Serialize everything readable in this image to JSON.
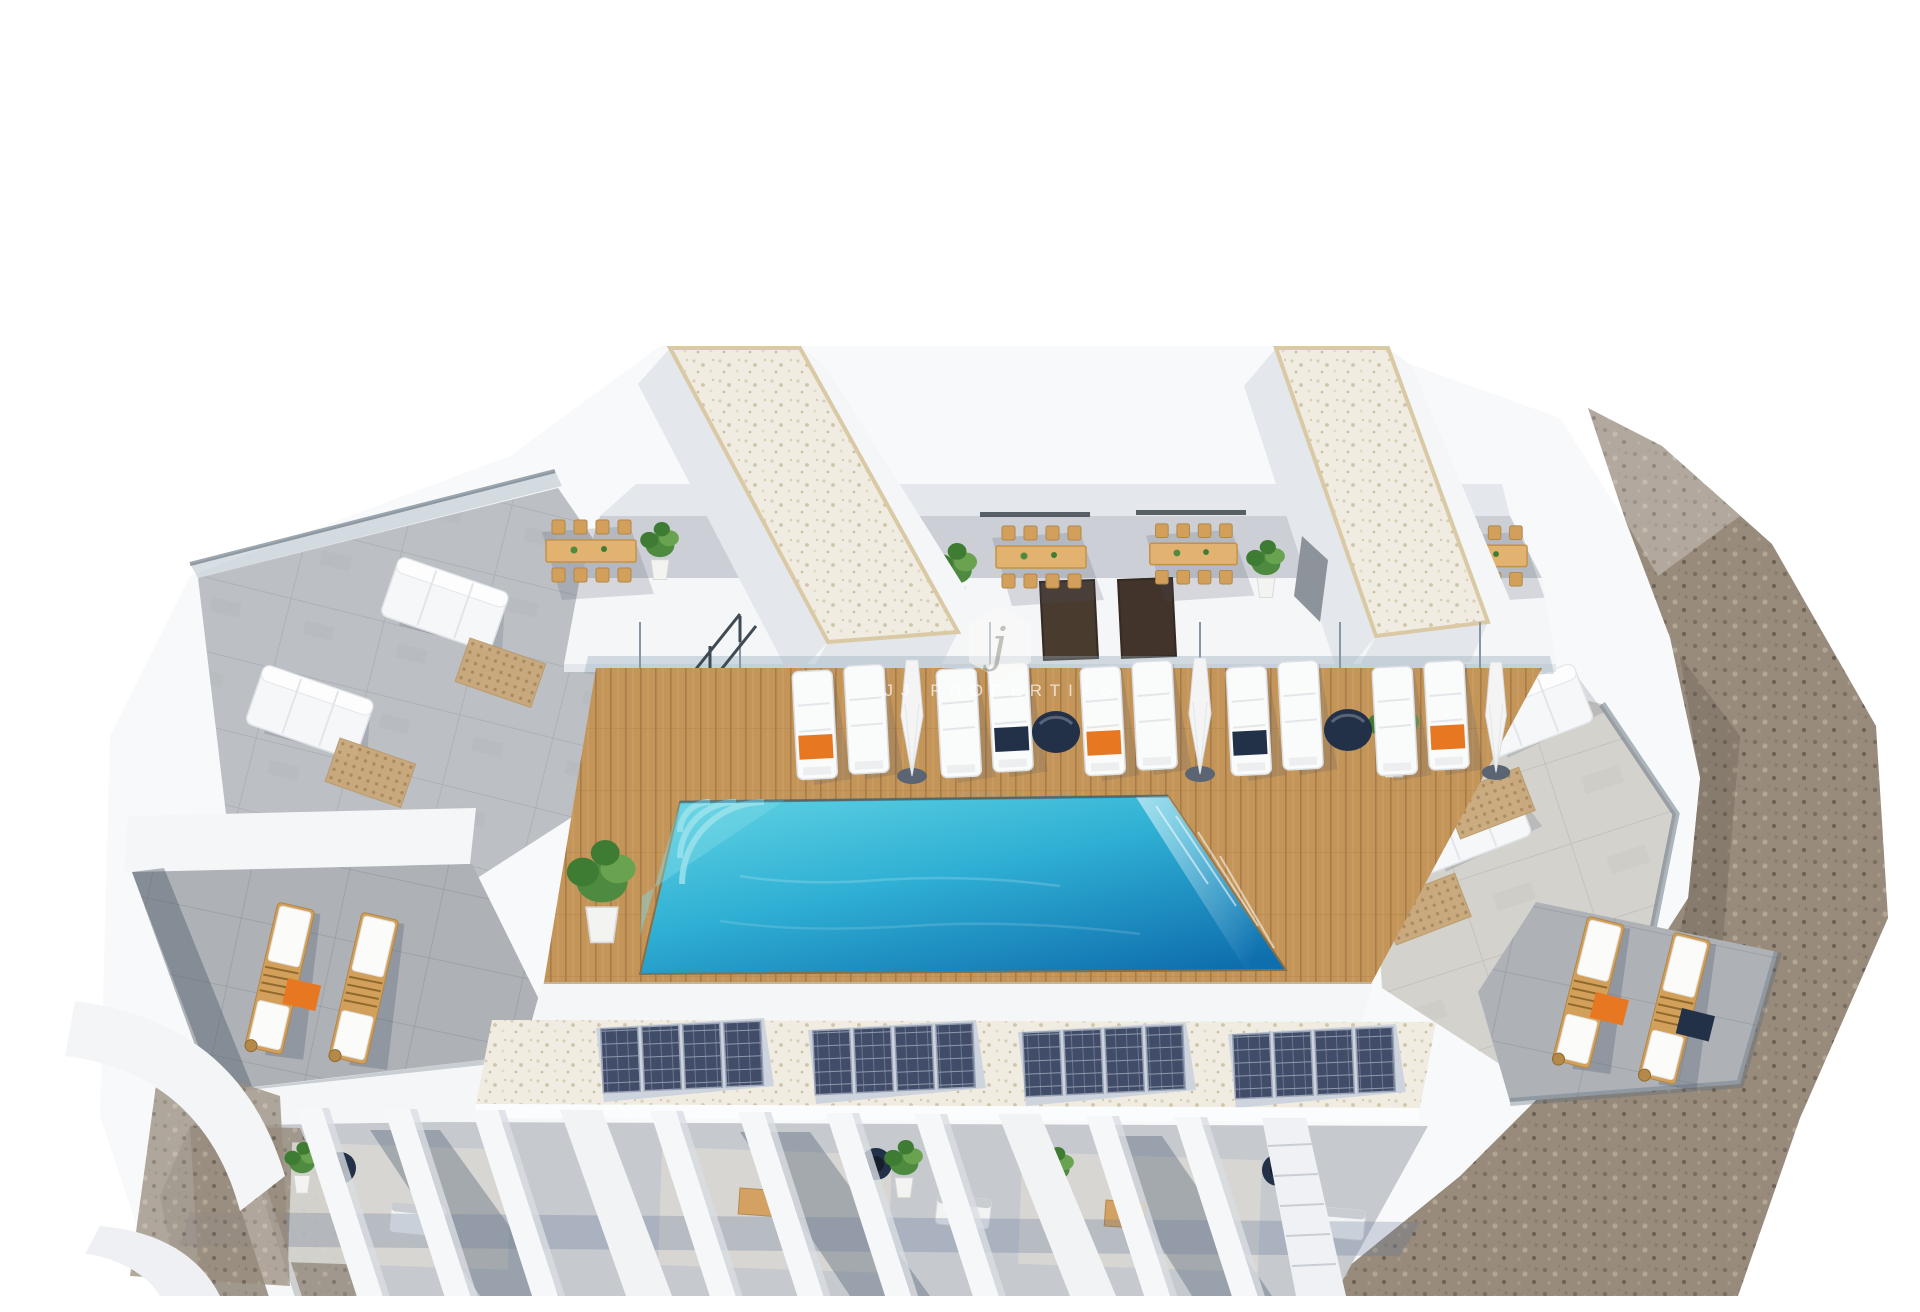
{
  "meta": {
    "type": "3d-architectural-render",
    "view": "aerial front view",
    "subject": "Rooftop communal terrace of a modern white residential building with a turquoise swimming pool on a wooden sun deck, rows of white sun loungers with parasols, four outdoor dining sets, two roof-access towers with gravel roofs, side lounge terraces with white sofas and wooden deckchairs, a row of solar panel arrays and private pergola terraces along the front, bordered by rocky gravel ground",
    "background": "#ffffff"
  },
  "watermark": {
    "logo_letter": "j",
    "text": "JJ PROPERTIES"
  },
  "colors": {
    "pool_shallow": "#5ed1e2",
    "pool_mid": "#2fb0d4",
    "pool_deep": "#0f6fae",
    "deck_wood": "#c49559",
    "deck_wood_dark": "#a87c49",
    "furniture_wood": "#d3a05c",
    "accent_orange": "#e87722",
    "accent_navy": "#223048",
    "concrete": "#bcc0c5",
    "concrete_dark": "#aeb2b7",
    "stone": "#d4d2cd",
    "gravel": "#988b7c",
    "white_gravel": "#f1ece1",
    "solar_panel": "#414d68",
    "wall_white": "#f5f6f8",
    "wall_shade": "#e4e7ec",
    "plant_green": "#4e8a3f",
    "glass_tint": "rgba(150,170,185,0.38)"
  },
  "scene": {
    "counts": {
      "deck_lounger_pairs": 5,
      "closed_parasols": 3,
      "round_poufs": 2,
      "dining_sets": 4,
      "roof_towers": 2,
      "solar_arrays": 4,
      "panels_per_array": 4,
      "side_wood_loungers_per_wing": 2,
      "pergola_beams": 10
    }
  }
}
